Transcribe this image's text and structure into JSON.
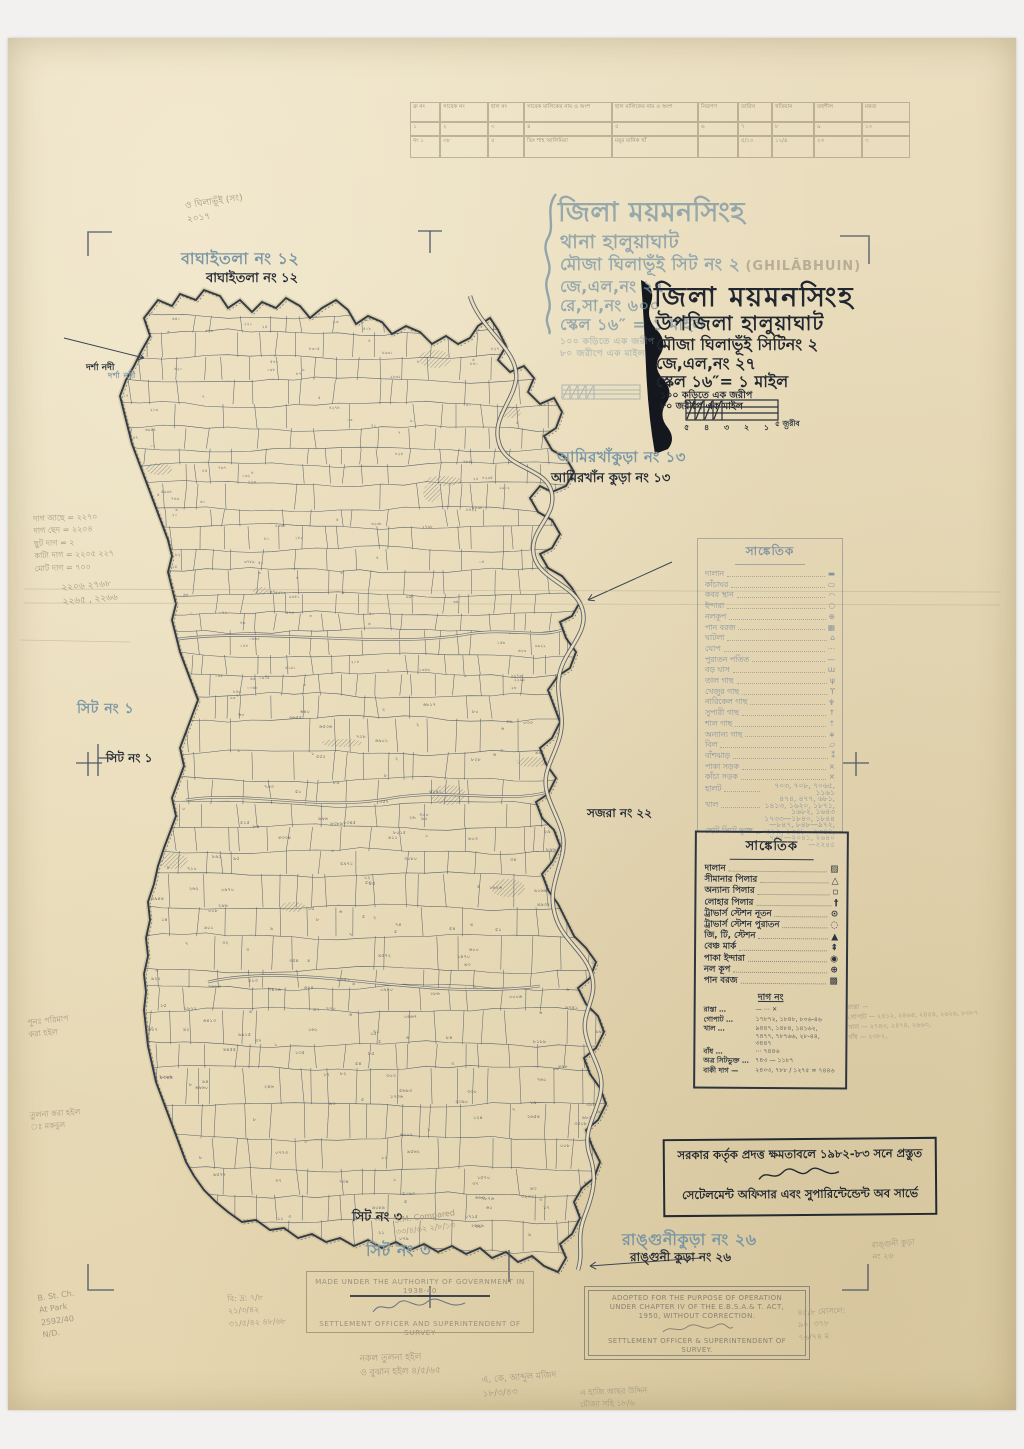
{
  "title_blue": {
    "l1": "জিলা ময়মনসিংহ",
    "l2": "থানা হালুয়াঘাট",
    "l3": "মৌজা ঘিলাভূঁই সিট নং ২",
    "l3_latin": "(GHILĀBHUIN)",
    "l4": "জে,এল,নং ২৭",
    "l5": "রে,সা,নং ৬০০",
    "l6": "স্কেল ১৬″ = ১ মাইল",
    "sub1": "১০০ কড়িতে এক জরীপ",
    "sub2": "৮০ জরীপে এক মাইল"
  },
  "title_black": {
    "b1": "জিলা ময়মনসিংহ",
    "b2": "উপজিলা হালুয়াঘাট",
    "b3": "মৌজা ঘিলাভূঁই সিটিনং ২",
    "b4": "জে,এল,নং ২৭",
    "b5": "স্কেল ১৬″= ১ মাইল",
    "b6": "১০০ কড়িতে এক জরীপ",
    "b7": "৮০ জরীপে এক মাইল",
    "scale_ticks": "৫ ৪ ৩ ২ ১ ০",
    "scale_label": "৫ জরীব"
  },
  "table": {
    "headers": [
      "ক্র নং",
      "সাবেক নং",
      "হাল নং",
      "সাবেক মালিকের নাম ও অংশ",
      "হাল মালিকের নাম ও অংশ",
      "নিরূপণ",
      "তারিখ",
      "খতিয়ান",
      "তহশীল",
      "মন্তব্য"
    ],
    "rows": [
      [
        "১",
        "২",
        "৩",
        "৪",
        "৫",
        "৬",
        "৭",
        "৮",
        "৯",
        "১০"
      ],
      [
        "নং ১",
        "৩৮",
        "৫",
        "ভিং শাহ আলিমিয়া",
        "ময়ূর মানিক খাঁ",
        "",
        "৫/১০",
        "১২/৪",
        "২৩",
        "৩"
      ]
    ]
  },
  "legend1": {
    "title": "সাঙ্কেতিক",
    "items": [
      {
        "label": "দালান",
        "sym": "▬"
      },
      {
        "label": "কাঁচাঘর",
        "sym": "▭"
      },
      {
        "label": "কবর স্থান",
        "sym": "◠"
      },
      {
        "label": "ইন্দারা",
        "sym": "○"
      },
      {
        "label": "নলকূপ",
        "sym": "⊕"
      },
      {
        "label": "পান বরজ",
        "sym": "▦"
      },
      {
        "label": "ঘাটলা",
        "sym": "⌂"
      },
      {
        "label": "ঘোপ",
        "sym": "⋯"
      },
      {
        "label": "পুরাতন পতিত",
        "sym": "—"
      },
      {
        "label": "বড় ঘাস",
        "sym": "ɯ"
      },
      {
        "label": "তাল গাছ",
        "sym": "ψ"
      },
      {
        "label": "খেজুর গাছ",
        "sym": "ϒ"
      },
      {
        "label": "নারিকেল গাছ",
        "sym": "♆"
      },
      {
        "label": "সুপারী গাছ",
        "sym": "↑"
      },
      {
        "label": "শাল গাছ",
        "sym": "⇡"
      },
      {
        "label": "অন্যান্য গাছ",
        "sym": "∗"
      },
      {
        "label": "বিল",
        "sym": "▱"
      },
      {
        "label": "বাঁশঝাড়",
        "sym": "⁑"
      },
      {
        "label": "পাকা সড়ক",
        "sym": "×"
      },
      {
        "label": "কাঁচা সড়ক",
        "sym": "×"
      },
      {
        "label": "হালট",
        "sym": "৭০৩, ৭০৮, ৭০৬৫, ১১৬১"
      },
      {
        "label": "খাল",
        "sym": "৪৭৪, ৪৭৭, ৬৮১, ১৪১৩, ১৬২০, ১৮৭১, ১৬৮২, ১৬৪৩"
      },
      {
        "label": "ছোট সিটে ভুক্ত",
        "sym": "১৭৩৩—১৮৪০, ১৮৪৪—৮৪৭, ৮৪৮—৯৭২, ৯৮৯, ১৩৪৮—২৩৪৪, ৭৩৫—২০৪১, ২৬৪০—২২৪৫"
      }
    ]
  },
  "legend2": {
    "title": "সাঙ্কেতিক",
    "items": [
      {
        "label": "দালান",
        "sym": "▨"
      },
      {
        "label": "সীমানার পিলার",
        "sym": "△"
      },
      {
        "label": "অন্যান্য পিলার",
        "sym": "▫"
      },
      {
        "label": "লোহার পিলার",
        "sym": "†"
      },
      {
        "label": "ট্রাভার্স স্টেশন নূতন",
        "sym": "⊙"
      },
      {
        "label": "ট্রাভার্স স্টেশন পুরাতন",
        "sym": "◌"
      },
      {
        "label": "জি, টি, স্টেশন",
        "sym": "▲"
      },
      {
        "label": "বেঞ্চ মার্ক",
        "sym": "⇞"
      },
      {
        "label": "পাকা ইন্দারা",
        "sym": "◉"
      },
      {
        "label": "নল কূপ",
        "sym": "⊕"
      },
      {
        "label": "পান বরজ",
        "sym": "▩"
      }
    ],
    "dag_title": "দাগ নং",
    "dag_rows": [
      {
        "label": "রাস্তা …",
        "nums": "—  ⋯  ✕"
      },
      {
        "label": "গোপাট …",
        "nums": "১৭৮৭২, ১৮৪৮, ৮০৬-৪৬"
      },
      {
        "label": "খাল …",
        "nums": "৯৪৪৭, ১৪৮৪, ১৪১৬২, ৭৪৭৭, ৭৮৭৬৬, ২৮-৪৪, ৩৪৪৭"
      },
      {
        "label": "বাঁধ …",
        "nums": "⋯  ৭৪৪৬"
      },
      {
        "label": "অত্র সিটভুক্ত …",
        "nums": "৭৪৩ — ১১৮৭"
      },
      {
        "label": "বাকী দাগ —",
        "nums": "২৪০৩, ৭৮৮ / ১২৭৫ = ৭৪৪৬"
      }
    ]
  },
  "stamps": {
    "bn": {
      "line1": "সরকার কর্তৃক প্রদত্ত ক্ষমতাবলে ১৯৮২-৮৩ সনে প্রস্তুত",
      "line2": "সেটেলমেন্ট অফিসার এবং সুপারিন্টেন্ডেন্ট অব সার্ভে"
    },
    "made": {
      "line1": "MADE UNDER THE AUTHORITY OF GOVERNMENT IN 1938-40",
      "line2": "SETTLEMENT OFFICER AND SUPERINTENDENT OF SURVEY"
    },
    "adopted": {
      "l1": "ADOPTED FOR THE PURPOSE OF OPERATION",
      "l2": "UNDER CHAPTER IV OF THE E.B.S.A.& T. ACT,",
      "l3": "1950, WITHOUT CORRECTION.",
      "f1": "SETTLEMENT OFFICER & SUPERINTENDENT OF",
      "f2": "SURVEY."
    }
  },
  "labels": [
    {
      "name": "label-baghaitala-print",
      "cls": "lbl-blue",
      "text": "বাঘাইতলা নং ১২",
      "x": 181,
      "y": 246,
      "s": 16
    },
    {
      "name": "label-baghaitala-hand",
      "cls": "lbl-ink",
      "text": "বাঘাইতলা নং ১২",
      "x": 206,
      "y": 269,
      "s": 13
    },
    {
      "name": "label-amirkhakura-print",
      "cls": "lbl-blue",
      "text": "আমিরখাঁকুড়া নং ১৩",
      "x": 557,
      "y": 446,
      "s": 15
    },
    {
      "name": "label-amirkhakura-hand",
      "cls": "lbl-ink",
      "text": "আমিরখাঁন কুড়া নং ১৩",
      "x": 551,
      "y": 469,
      "s": 13
    },
    {
      "name": "label-sheet1-print",
      "cls": "lbl-blue",
      "text": "সিট নং ১",
      "x": 77,
      "y": 697,
      "s": 14
    },
    {
      "name": "label-sheet1-hand",
      "cls": "lbl-ink",
      "text": "সিট নং ১",
      "x": 106,
      "y": 750,
      "s": 12
    },
    {
      "name": "label-sajra-hand",
      "cls": "lbl-ink",
      "text": "সজরা নং ২২",
      "x": 587,
      "y": 805,
      "s": 12
    },
    {
      "name": "label-sheet3-hand",
      "cls": "lbl-ink",
      "text": "সিট নং ৩",
      "x": 352,
      "y": 1208,
      "s": 13
    },
    {
      "name": "label-sheet3-print",
      "cls": "lbl-blue",
      "text": "সিট নং ৩",
      "x": 366,
      "y": 1238,
      "s": 16
    },
    {
      "name": "label-rangunikura-print",
      "cls": "lbl-blue",
      "text": "রাঙ্গুনীকুড়া নং ২৬",
      "x": 622,
      "y": 1227,
      "s": 16
    },
    {
      "name": "label-rangunikura-hand",
      "cls": "lbl-ink",
      "text": "রাঙ্গুনী কুড়া নং ২৬",
      "x": 630,
      "y": 1249,
      "s": 12
    },
    {
      "name": "label-darsha-river-hand",
      "cls": "lbl-ink",
      "text": "দর্শা নদী",
      "x": 86,
      "y": 360,
      "s": 9
    },
    {
      "name": "label-darsha-river-print",
      "cls": "lbl-blue",
      "text": "দর্শা নদী",
      "x": 108,
      "y": 370,
      "s": 8
    }
  ],
  "pencil": [
    {
      "name": "pencil-tally",
      "x": 34,
      "y": 512,
      "s": 8,
      "rot": -2,
      "lines": [
        "দাগ আছে = ২২৭০",
        "দাগ ছেদ = ২২০৪",
        "ছুট দাগ = ২",
        "কাটা দাগ = ২২০৫  ২২৭",
        "মোট দাগ = ৭০০"
      ]
    },
    {
      "name": "pencil-tally-sum",
      "x": 62,
      "y": 580,
      "s": 9,
      "rot": -5,
      "lines": [
        "২২০৬   ২৭৬৮",
        "২২৬৫ , ২২৬৬"
      ]
    },
    {
      "name": "pencil-dag-right",
      "x": 848,
      "y": 1000,
      "s": 6.5,
      "rot": -2,
      "lines": [
        "রাস্তা —",
        "গোপাট — ২৪১২, ২৪৬৪, ২৪৫৪, ২৬২৬, ৮৩৮৭",
        "খাল — ২৭৪৩, ২৪৭৪, ২৬৬৩,",
        "বাঁধ — ২৩৮২,"
      ]
    },
    {
      "name": "pencil-compared",
      "x": 395,
      "y": 1211,
      "s": 8,
      "rot": -7,
      "lines": [
        "S.M. Compared",
        "৩৩/৪/৬২  ২/৮/১৩"
      ]
    },
    {
      "name": "pencil-corner-note",
      "x": 40,
      "y": 1290,
      "s": 8,
      "rot": -8,
      "lines": [
        "B. St. Ch.",
        "At Park",
        "2592/40",
        "N/D."
      ]
    },
    {
      "name": "pencil-dates-left",
      "x": 228,
      "y": 1292,
      "s": 8,
      "rot": -3,
      "lines": [
        "বি: দ্র: ৭/৮",
        "২১/৩/৪২",
        "৩১/৫/৪২  ৪৮/৬৮"
      ]
    },
    {
      "name": "pencil-bottom-center",
      "x": 360,
      "y": 1352,
      "s": 9,
      "rot": -2,
      "lines": [
        "নকল তুলনা হইল",
        "ও বুঝান হইল  ৪/৫/৬৫"
      ]
    },
    {
      "name": "pencil-bottom-mid",
      "x": 482,
      "y": 1372,
      "s": 9,
      "rot": -4,
      "lines": [
        "এ, কে, আব্দুল মজিদ",
        "১৮/৩/৪৩"
      ]
    },
    {
      "name": "pencil-bottom-right",
      "x": 798,
      "y": 1306,
      "s": 8,
      "rot": -3,
      "lines": [
        "৪৫/৮ মোসলে:",
        "৯০: ৩৭৮",
        "৭৬/৭৪ ম"
      ]
    },
    {
      "name": "pencil-top-note",
      "x": 186,
      "y": 196,
      "s": 9,
      "rot": -8,
      "lines": [
        "ও ঘিলাভূঁই (সং)",
        "২০১৭"
      ]
    },
    {
      "name": "pencil-left-lower",
      "x": 28,
      "y": 1015,
      "s": 8,
      "rot": -6,
      "lines": [
        "পুনঃ পরিমাপ",
        "করা হইল"
      ]
    },
    {
      "name": "pencil-left-lower2",
      "x": 30,
      "y": 1108,
      "s": 8,
      "rot": -4,
      "lines": [
        "তুলনা করা হইল",
        "ঃ মকবুল"
      ]
    },
    {
      "name": "pencil-bottom-far",
      "x": 580,
      "y": 1386,
      "s": 8,
      "rot": -2,
      "lines": [
        "এ হাজি আছর উদ্দিন",
        "মৌজা সহি ১৮/৬"
      ]
    },
    {
      "name": "pencil-26-note",
      "x": 872,
      "y": 1238,
      "s": 8,
      "rot": -4,
      "lines": [
        "রাঙ্গুনী কুড়া",
        "নং ২৬"
      ]
    }
  ],
  "map": {
    "plot_digits": "০১২৩৪৫৬৭৮৯",
    "outline": "M150,336L144,318L158,300L172,306L180,294L196,300L204,290L220,296L228,308L240,300L252,312L262,302L276,308L286,298L300,306L310,318L322,308L336,300L348,310L356,324L368,316L382,322L392,334L406,326L420,332L432,344L446,336L458,344L470,338L478,326L490,318L498,330L506,346L498,360L510,372L524,366L534,378L528,392L540,404L554,398L562,412L556,428L544,436L552,450L566,458L574,472L566,486L552,492L540,486L530,498L538,512L552,520L560,534L552,548L540,554L548,568L562,576L572,588L580,602L572,616L560,622L566,638L576,652L570,668L558,676L548,690L554,706L560,722L552,738L540,748L546,764L556,778L548,794L536,802L542,818L554,830L560,846L552,862L542,874L548,890L558,904L566,920L574,936L586,948L596,962L590,978L578,988L586,1004L598,1016L604,1032L596,1048L584,1058L590,1074L600,1088L606,1104L598,1120L586,1130L592,1146L600,1162L594,1178L582,1188L574,1202L580,1218L572,1234L560,1244L566,1258L558,1272L544,1266L532,1256L518,1262L506,1252L492,1258L480,1248L466,1254L452,1246L438,1252L424,1244L410,1250L396,1242L382,1248L368,1240L354,1246L340,1238L326,1242L312,1234L298,1238L284,1228L270,1230L256,1220L242,1222L228,1212L216,1202L204,1190L194,1176L186,1162L180,1146L174,1130L168,1114L162,1098L156,1082L152,1064L148,1046L146,1028L144,1010L146,992L144,974L148,956L146,938L150,920L148,902L154,884L158,866L164,848L170,832L176,816L172,798L178,782L184,766L180,748L186,732L192,716L198,700L192,684L186,668L180,652L176,636L172,620L176,604L172,588L168,572L172,556L168,540L162,524L156,508L150,492L144,476L138,460L132,444L128,428L124,412L120,396L126,380L134,366L142,350Z",
    "river": "M470,296 C480,330 520,350 516,380 C512,404 490,420 500,446 C510,470 548,468 552,494 C556,518 528,530 534,556 C540,580 574,584 582,608 C590,632 566,648 560,672 C554,696 566,712 560,736 C554,760 540,772 548,796 C556,820 568,832 562,856 C556,880 548,894 556,918 C564,942 586,952 592,976 C598,1000 580,1012 586,1036 C592,1060 606,1072 600,1096 C594,1120 582,1132 590,1156 C598,1180 592,1196 584,1218 C576,1240 584,1252 578,1270",
    "roads": [
      "M172,640 C260,626 380,650 468,634 C510,627 545,640 566,628",
      "M208,982 C300,960 420,1002 540,986",
      "M186,800 C250,790 320,812 392,798 C450,788 505,804 548,792"
    ]
  }
}
